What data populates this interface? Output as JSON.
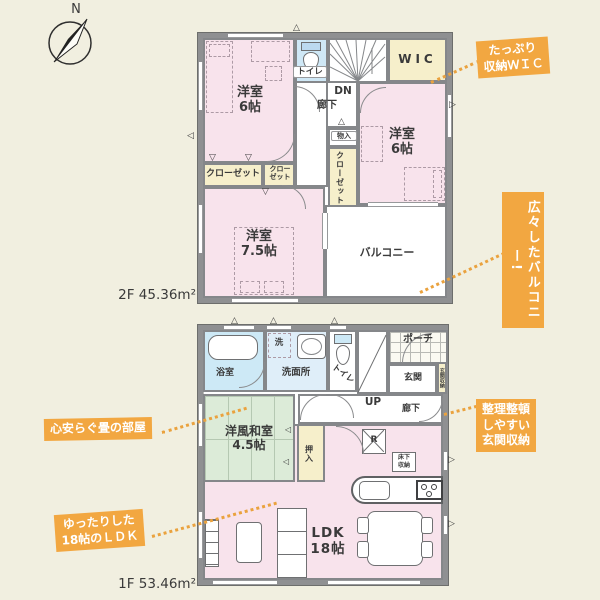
{
  "colors": {
    "background": "#f1efe0",
    "wall": "#8f9092",
    "room_pink": "#f8e3ec",
    "closet_cream": "#f6efcb",
    "bath_blue": "#cde9f6",
    "washroom_blue": "#dfeef9",
    "tatami_green": "#dcebd8",
    "callout_orange": "#f2a741",
    "leader_orange": "#eaa23e",
    "text": "#3a3a3a"
  },
  "compass": {
    "n": "N"
  },
  "icons": {
    "marker_up": "△",
    "marker_down": "▽",
    "marker_left": "◁",
    "marker_right": "▷"
  },
  "floor2": {
    "area": "2F 45.36m²",
    "rooms": {
      "bedroom_tl": "洋室\n6帖",
      "toilet": "トイレ",
      "wic": "WIC",
      "dn": "DN",
      "hallway": "廊下",
      "bedroom_r": "洋室\n6帖",
      "storage": "物入",
      "closet_center": "クローゼット",
      "closet_left": "クローゼット",
      "closet_small": "クロー\nゼット",
      "bedroom_b": "洋室\n7.5帖",
      "balcony": "バルコニー"
    }
  },
  "floor1": {
    "area": "1F 53.46m²",
    "rooms": {
      "bath": "浴室",
      "washer": "洗",
      "washroom": "洗面所",
      "toilet": "トイレ",
      "up": "UP",
      "porch": "ポーチ",
      "entrance": "玄関",
      "entrance_storage": "玄関収納",
      "hallway": "廊下",
      "washitsu": "洋風和室\n4.5帖",
      "oshiire": "押入",
      "fridge": "R",
      "floor_storage": "床下\n収納",
      "ldk": "LDK\n18帖"
    }
  },
  "callouts": {
    "wic": "たっぷり\n収納ＷＩＣ",
    "balcony": "広々したバルコニー!",
    "tatami": "心安らぐ畳の部屋",
    "ldk": "ゆったりした\n18帖のＬＤＫ",
    "entrance": "整理整頓\nしやすい\n玄関収納"
  }
}
